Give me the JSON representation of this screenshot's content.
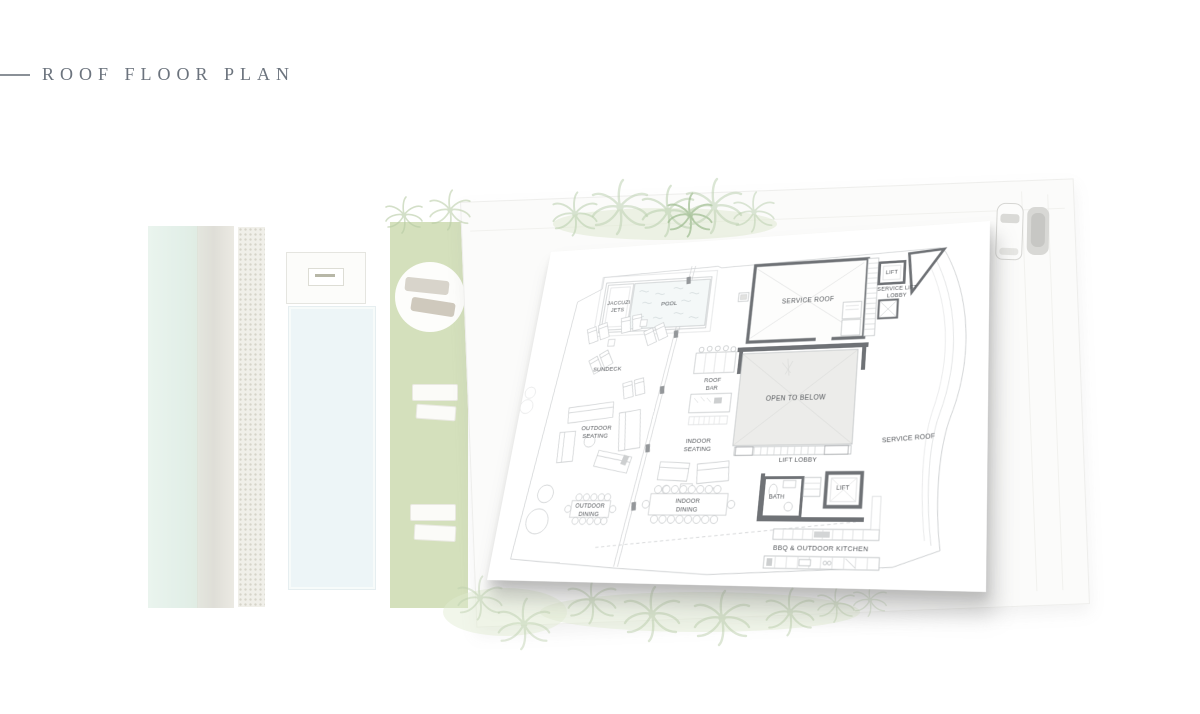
{
  "header": {
    "title": "ROOF FLOOR PLAN"
  },
  "plan": {
    "rooms": [
      {
        "id": "jacuzzi-jets",
        "label": "JACCUZI JETS"
      },
      {
        "id": "pool",
        "label": "POOL"
      },
      {
        "id": "service-roof-top",
        "label": "SERVICE ROOF"
      },
      {
        "id": "lift-top",
        "label": "LIFT"
      },
      {
        "id": "service-lift-lobby",
        "label": "SERVICE LIFT LOBBY"
      },
      {
        "id": "sundeck",
        "label": "SUNDECK"
      },
      {
        "id": "roof-bar",
        "label": "ROOF BAR"
      },
      {
        "id": "open-to-below",
        "label": "OPEN TO BELOW"
      },
      {
        "id": "outdoor-seating",
        "label": "OUTDOOR SEATING"
      },
      {
        "id": "indoor-seating",
        "label": "INDOOR SEATING"
      },
      {
        "id": "service-roof-right",
        "label": "SERVICE ROOF"
      },
      {
        "id": "lift-lobby",
        "label": "LIFT LOBBY"
      },
      {
        "id": "bath",
        "label": "BATH"
      },
      {
        "id": "lift-bottom",
        "label": "LIFT"
      },
      {
        "id": "outdoor-dining",
        "label": "OUTDOOR DINING"
      },
      {
        "id": "indoor-dining",
        "label": "INDOOR DINING"
      },
      {
        "id": "bbq-outdoor-kitchen",
        "label": "BBQ & OUTDOOR KITCHEN"
      }
    ]
  },
  "colors": {
    "title": "#6b737d",
    "wall": "#6f7276",
    "plan_line": "#b9bdbf",
    "lawn": "#d4e0bc",
    "water": "#e6f2ec",
    "pool_water": "#edf5f7",
    "palm": "#b9cfad"
  }
}
